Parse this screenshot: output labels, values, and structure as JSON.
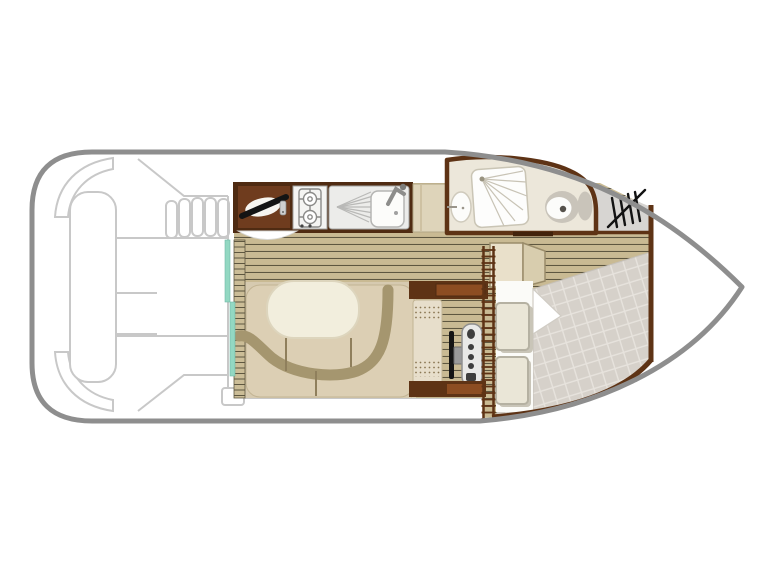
{
  "plan": {
    "type": "boat-floor-plan",
    "vessel_layout": "motor-cruiser-top-view",
    "areas": {
      "aft_deck": "aft-deck-with-bench-engine-hatch-and-steps",
      "entry": "sliding-glass-door",
      "galley": "galley-with-fridge-two-burner-stove-and-sink",
      "dinette": "u-shaped-dinette-with-table",
      "helm": "inside-helm-with-wheel-and-console",
      "shower_room": "shower-room-with-washbasin-shower-and-toilet",
      "bow_cabin": "bow-cabin-with-double-bed-wardrobe-and-accordion-door",
      "anchor_locker": "bow-locker-with-hatch-symbol",
      "bow_deck": "bow-deck"
    }
  },
  "colors": {
    "background": "#ffffff",
    "hull_outline": "#8e8e8e",
    "deck_line": "#c8c8c8",
    "wall": "#5e3315",
    "frame_dark": "#4f2b12",
    "cabinet_red_brown": "#6f3c1e",
    "wood_inset": "#8c4d22",
    "plank": "#c9ba93",
    "plank_line": "#5e5740",
    "carpet": "#d6cab0",
    "bench": "#dccfb4",
    "bench_edge": "#c2b493",
    "backrest": "#a5966f",
    "table": "#f2eedd",
    "table_edge": "#ddd5bd",
    "teal_door": "#93d8c2",
    "bathroom_floor": "#ece7da",
    "fixture_gray": "#c9c4ba",
    "fixture_white": "#fcfcfa",
    "locker_gray": "#d7d5d2",
    "hatch_symbol": "#121212",
    "quilt": "#d6d1ca",
    "quilt_grid": "#e7e3dd",
    "sheet": "#fbfbf8",
    "pillow": "#eae6d7",
    "pillow_edge": "#b5b1a2",
    "seat": "#e7decb",
    "seat_dot": "#8a7753",
    "console": "#e9e9e7",
    "console_edge": "#8f8f8f",
    "button_dark": "#3e3e3e",
    "wheel": "#151515",
    "hub": "#9a9a9a",
    "steel": "#ececea",
    "appliance": "#f4f4f2",
    "appliance_line": "#8a8a88",
    "shower_line": "#c8c3b5",
    "white_unit": "#ffffff"
  }
}
